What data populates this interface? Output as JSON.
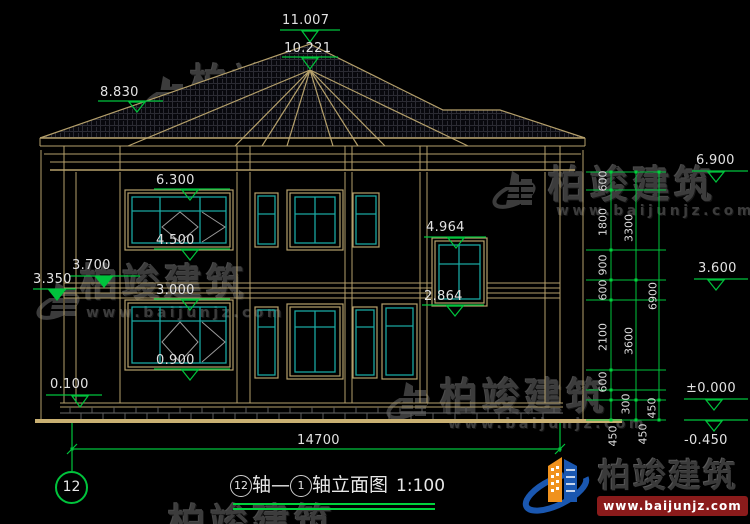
{
  "drawing": {
    "type": "house elevation CAD drawing",
    "title": {
      "axis_start_bubble": "12",
      "axis_joint": "轴—",
      "axis_end_bubble": "1",
      "suffix": "轴立面图",
      "scale": "1:100"
    },
    "axis_bubble_bottom_left": "12",
    "levels": {
      "ridge_top": "11.007",
      "bay_ridge": "10.221",
      "roof_left": "8.830",
      "win2_head": "6.300",
      "win2_sill": "4.500",
      "porch_beam": "3.700",
      "porch_soffit": "3.350",
      "win1_head": "3.000",
      "win1_sill": "0.900",
      "plinth_top": "0.100",
      "stair_win_head": "4.964",
      "stair_win_sill": "2.864",
      "eave_right": "6.900",
      "floor2_right": "3.600",
      "ground_zero": "±0.000",
      "site_ground": "-0.450"
    },
    "dim_chain_inner": [
      "600",
      "1800",
      "900",
      "600",
      "2100",
      "600",
      "300",
      "450"
    ],
    "dim_chain_mid": [
      "3300",
      "3600",
      "450"
    ],
    "dim_chain_outer": [
      "6900",
      "450"
    ],
    "dim_total_width": "14700"
  },
  "watermark": {
    "name": "柏竣建筑",
    "site": "www.baijunjz.com"
  },
  "logo": {
    "name": "柏竣建筑",
    "site": "www.baijunjz.com"
  },
  "colors": {
    "background": "#000000",
    "wall_lines": "#b5a06b",
    "ground_line": "#c9b072",
    "window_glass": "#1aa7a1",
    "dimension_green": "#00c43c",
    "text": "#e2e2e2",
    "watermark_gray": "#3c3c3c",
    "logo_blue": "#1a57b0",
    "logo_orange": "#f0921e",
    "logo_bar_red": "#8a1b1b"
  }
}
